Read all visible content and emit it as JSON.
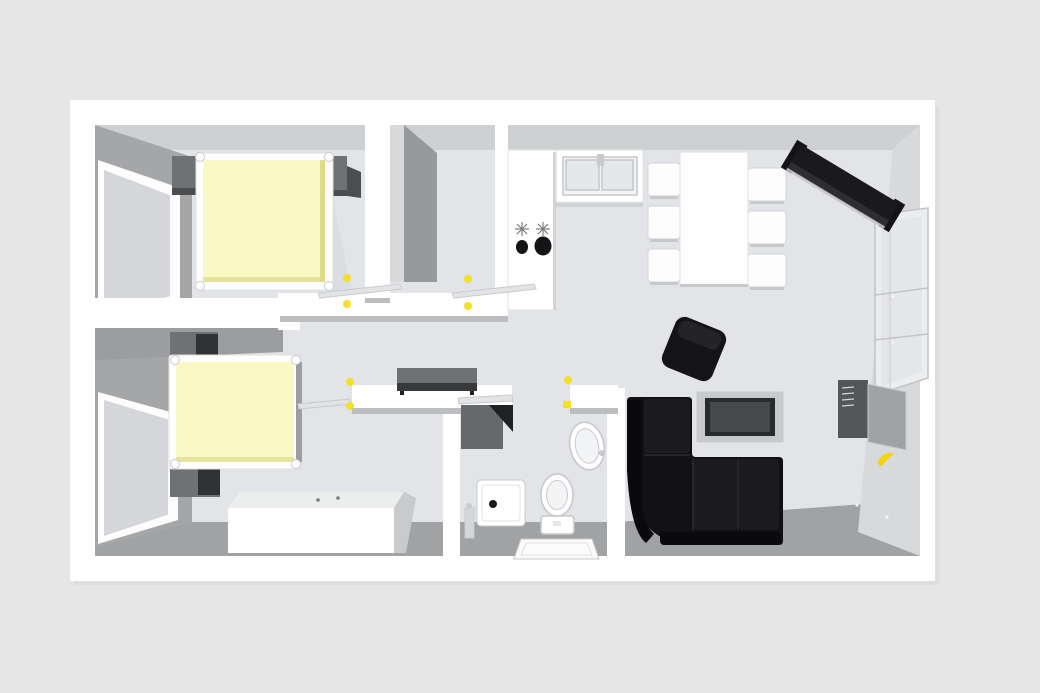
{
  "scene": {
    "description": "3D top-down rendered floor plan of a two-bedroom apartment",
    "objects": [
      "double-bed-top",
      "double-bed-bottom",
      "nightstand",
      "window",
      "wardrobe-wall",
      "kitchen-counter",
      "stove-two-burners",
      "kitchen-sink",
      "dining-table",
      "dining-chair",
      "sideboard-diagonal",
      "glass-shelf-unit",
      "wall-cabinet-open",
      "banana",
      "corner-sofa",
      "tv-on-stand",
      "ottoman",
      "hallway-sideboard",
      "washing-machine",
      "shower-tray",
      "washbasin",
      "toilet",
      "bath-mat",
      "door-leaf",
      "door-knob",
      "light-switch",
      "dresser-chest"
    ]
  },
  "colors": {
    "background": "#e6e6e6",
    "slab": "#ffffff",
    "slab_shadow": "#d8d8d8",
    "floor": "#e2e4e7",
    "top_face": "#cfd0d2",
    "bottom_face": "#a0a2a4",
    "left_face": "#a5a6a8",
    "room2_top_face": "#9b9da0",
    "closet_face": "#97999b",
    "face_step": "#d9dadb",
    "right_face": "#d8d9db",
    "wall_white": "#ffffff",
    "wall_lip": "#bcbdbf",
    "window_frame": "#fdfdfe",
    "window_glass": "#d4d6d9",
    "glass_unit": "#ecedef",
    "glass_unit_pane": "#e4e6e8",
    "duvet": "#f9f9c5",
    "duvet_edge": "#dedc8a",
    "bed_frame": "#fefefe",
    "bed_shadow": "#d6d8db",
    "nightstand": "#6f7173",
    "nightstand_dark": "#4b4d4f",
    "nightstand_black": "#303234",
    "chest_front": "#ffffff",
    "chest_top": "#eceded",
    "chest_side": "#c9cacc",
    "counter": "#ffffff",
    "burner": "#141416",
    "knob_gray": "#7b7d7f",
    "sink_recess": "#f2f3f4",
    "basin": "#e6e7e9",
    "chair": "#fdfdfd",
    "table": "#fefefe",
    "shadow_line": "#c8c9cb",
    "sideboard": "#1a1a1c",
    "sideboard_edge": "#2e2e30",
    "sideboard_light": "#c9c9cb",
    "ottoman": "#141416",
    "ottoman_light": "#242426",
    "sofa": "#111113",
    "sofa_back": "#0a0a0c",
    "sofa_seat": "#1c1c1e",
    "sofa_seam": "#2e2e30",
    "tv_frame": "#c8c9cb",
    "tv_border": "#2a2b2d",
    "tv_screen": "#46484a",
    "hall_sideboard_top": "#6f7173",
    "hall_sideboard_front": "#37393b",
    "washer": "#66686b",
    "washer_dark": "#1f2123",
    "fixture_white": "#ffffff",
    "fixture_inner": "#f3f4f5",
    "drain": "#1a1a1c",
    "mat": "#fbfbfc",
    "cabinet_interior": "#54565a",
    "cabinet_door": "#a0a2a4",
    "accent_yellow": "#f2e126",
    "banana_yellow": "#f0d40e",
    "door_leaf": "#e2e3e5",
    "dot_white": "#f5f5f5"
  }
}
